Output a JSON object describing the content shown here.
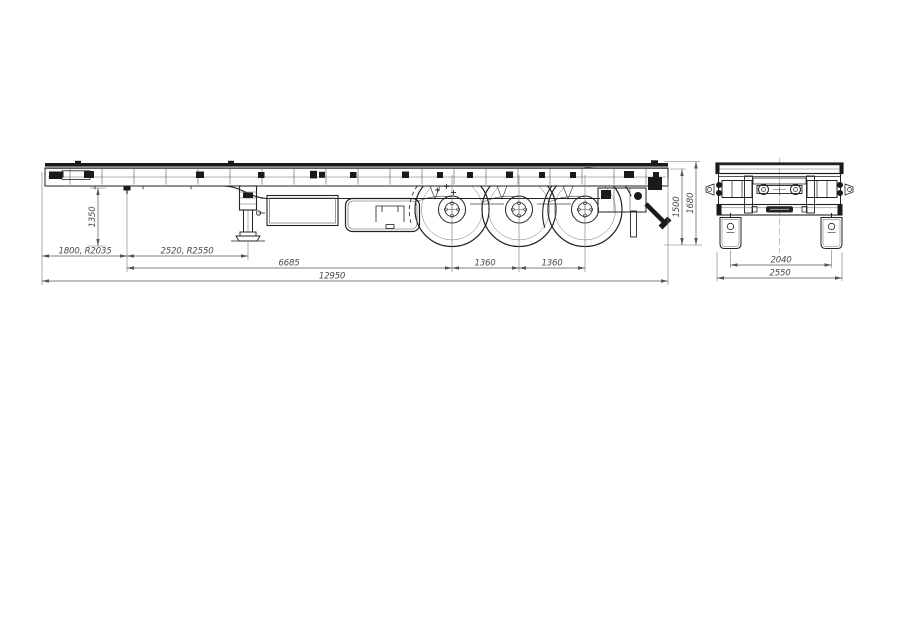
{
  "page": {
    "background": "#ffffff",
    "description": "Technical engineering drawing of a 3-axle flatbed container semitrailer: side view with dimensions and rear view with dimensions"
  },
  "drawing": {
    "line_color": "#222222",
    "dim_color": "#555555",
    "side_view": {
      "dim_front_height": "1350",
      "dim_front_overhang": "1800, R2035",
      "dim_kingpin_to_legs": "2520, R2550",
      "dim_kingpin_to_axle1": "6685",
      "dim_axle_spacing_1": "1360",
      "dim_axle_spacing_2": "1360",
      "dim_overall_length": "12950",
      "dim_deck_height": "1500",
      "dim_overall_height": "1680"
    },
    "rear_view": {
      "dim_track_width": "2040",
      "dim_overall_width": "2550"
    }
  }
}
